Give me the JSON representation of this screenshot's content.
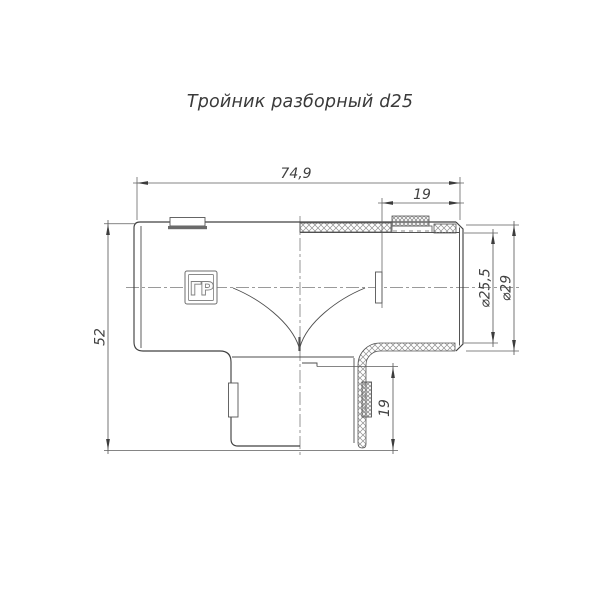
{
  "title": "Тройник разборный d25",
  "drawing": {
    "type": "technical-drawing",
    "part_marking": "ГР",
    "dimensions": {
      "overall_width": "74,9",
      "top_socket_depth": "19",
      "overall_height": "52",
      "bottom_socket_depth": "19",
      "bore_diameter": "⌀25,5",
      "outer_diameter": "⌀29"
    }
  },
  "colors": {
    "background": "#ffffff",
    "outline": "#414141",
    "secondary_line": "#4d4d4d",
    "dimension_line": "#5d5d5d",
    "centerline": "#7a7a7a",
    "hatch": "#8f8f8f",
    "text": "#3a3a3a"
  }
}
